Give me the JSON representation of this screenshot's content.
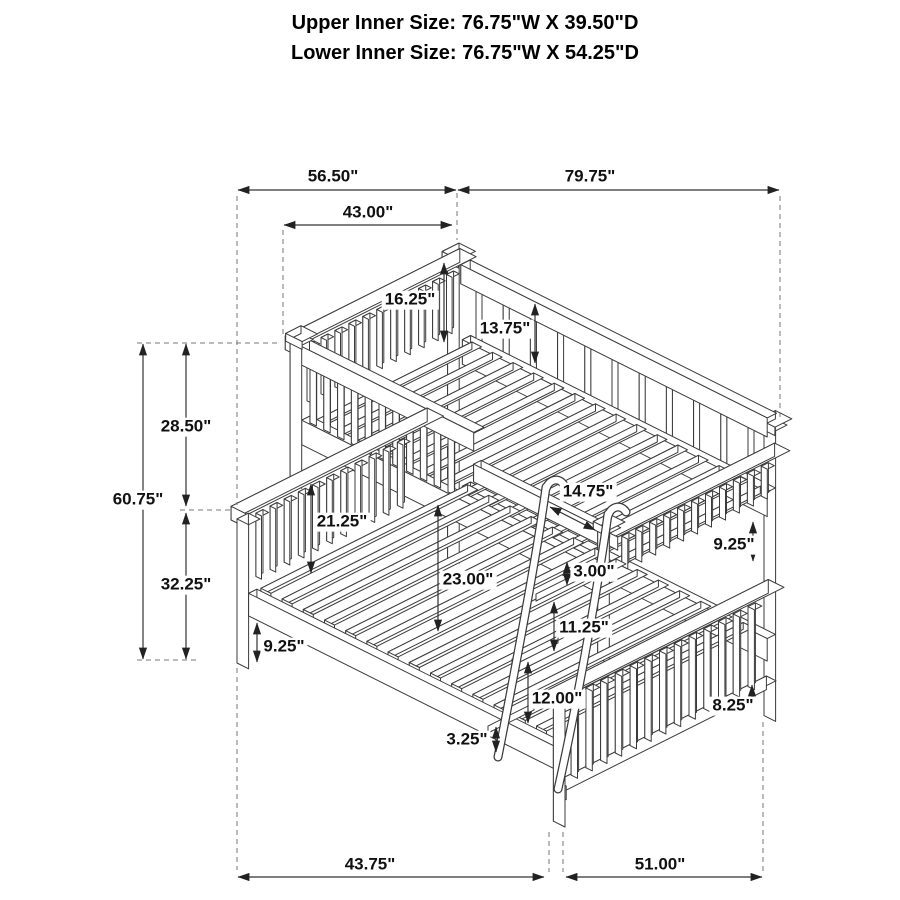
{
  "title": {
    "line1": "Upper Inner Size: 76.75\"W X 39.50\"D",
    "line2": "Lower Inner Size: 76.75\"W X 54.25\"D"
  },
  "dims": {
    "top_depth": "56.50\"",
    "top_length": "79.75\"",
    "upper_headboard_depth": "43.00\"",
    "left_total_height": "60.75\"",
    "left_upper_height": "28.50\"",
    "left_lower_height": "32.25\"",
    "left_rail_floor_gap": "9.25\"",
    "upper_guardrail_height": "16.25\"",
    "upper_rear_rail_height": "13.75\"",
    "lower_headboard_height": "21.25\"",
    "under_bunk_clearance": "23.00\"",
    "post_offset": "14.75\"",
    "ladder_hook_gap": "3.00\"",
    "ladder_step_gap_upper": "11.25\"",
    "footboard_guard_height": "9.25\"",
    "ladder_step_gap_lower": "12.00\"",
    "ladder_bottom_gap": "3.25\"",
    "footboard_rail_gap": "8.25\"",
    "bottom_left_span": "43.75\"",
    "bottom_right_span": "51.00\""
  }
}
